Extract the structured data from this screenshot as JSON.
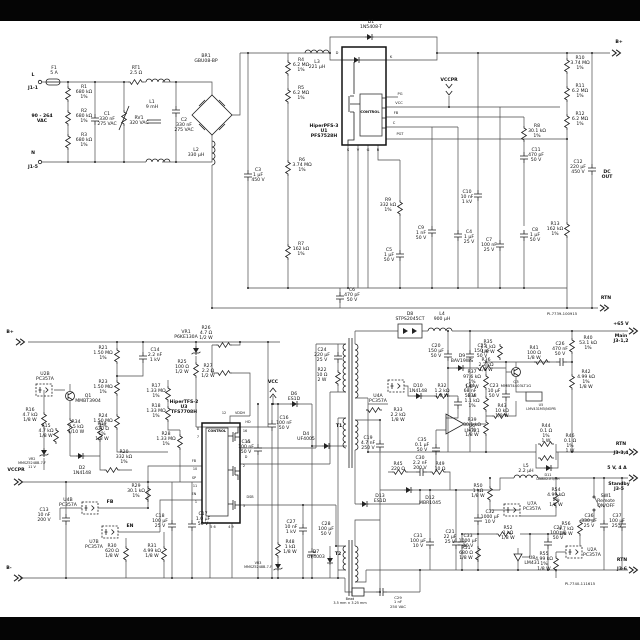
{
  "page": {
    "background": "#ffffff",
    "letterbox_color": "#050505"
  },
  "doc_ids": {
    "top_sheet": "PI-7739-100915",
    "bottom_sheet": "PI-7740-111615"
  },
  "labels": [
    {
      "t": "F1\n5 A",
      "x": 54,
      "y": 66
    },
    {
      "t": "L",
      "x": 33,
      "y": 73,
      "b": 1
    },
    {
      "t": "J1-1",
      "x": 33,
      "y": 86,
      "b": 1
    },
    {
      "t": "90 - 264\nVAC",
      "x": 42,
      "y": 114,
      "b": 1
    },
    {
      "t": "N",
      "x": 33,
      "y": 151,
      "b": 1
    },
    {
      "t": "J1-5",
      "x": 33,
      "y": 165,
      "b": 1
    },
    {
      "t": "R1\n680 kΩ\n1%",
      "x": 84,
      "y": 85
    },
    {
      "t": "R2\n680 kΩ\n1%",
      "x": 84,
      "y": 109
    },
    {
      "t": "R3\n680 kΩ\n1%",
      "x": 84,
      "y": 133
    },
    {
      "t": "C1\n330 nF\n275 VAC",
      "x": 107,
      "y": 112
    },
    {
      "t": "RV1\n320 VAC",
      "x": 139,
      "y": 116
    },
    {
      "t": "RT1\n2.5 Ω",
      "x": 136,
      "y": 66
    },
    {
      "t": "L1\n9 mH",
      "x": 152,
      "y": 100
    },
    {
      "t": "C2\n330 nF\n275 VAC",
      "x": 184,
      "y": 118
    },
    {
      "t": "BR1\nGBU08-BP",
      "x": 206,
      "y": 54
    },
    {
      "t": "L2\n330 µH",
      "x": 196,
      "y": 148
    },
    {
      "t": "D1\n1N5408-T",
      "x": 371,
      "y": 20
    },
    {
      "t": "L3\n221 µH",
      "x": 317,
      "y": 60
    },
    {
      "t": "HiperPFS-3\nU1\nPFS7528H",
      "x": 324,
      "y": 124,
      "b": 1
    },
    {
      "t": "CONTROL",
      "x": 370,
      "y": 110,
      "s": 3.6,
      "b": 1
    },
    {
      "t": "D",
      "x": 337,
      "y": 51,
      "s": 3.6
    },
    {
      "t": "K",
      "x": 391,
      "y": 55,
      "s": 3.6
    },
    {
      "t": "PG",
      "x": 400,
      "y": 92,
      "s": 3.6
    },
    {
      "t": "VCC",
      "x": 399,
      "y": 101,
      "s": 3.6
    },
    {
      "t": "FB",
      "x": 396,
      "y": 111,
      "s": 3.6
    },
    {
      "t": "C",
      "x": 394,
      "y": 121,
      "s": 3.6
    },
    {
      "t": "PGT",
      "x": 400,
      "y": 132,
      "s": 3.6
    },
    {
      "t": "S",
      "x": 348,
      "y": 148,
      "s": 3.6
    },
    {
      "t": "V",
      "x": 358,
      "y": 148,
      "s": 3.6
    },
    {
      "t": "G",
      "x": 368,
      "y": 148,
      "s": 3.6
    },
    {
      "t": "R",
      "x": 378,
      "y": 148,
      "s": 3.6
    },
    {
      "t": "VCCPR",
      "x": 449,
      "y": 78,
      "b": 1
    },
    {
      "t": "R4\n6.2 MΩ\n1%",
      "x": 301,
      "y": 58
    },
    {
      "t": "R5\n6.2 MΩ\n1%",
      "x": 301,
      "y": 86
    },
    {
      "t": "R6\n3.74 MΩ\n1%",
      "x": 302,
      "y": 158
    },
    {
      "t": "C3\n1 µF\n450 V",
      "x": 258,
      "y": 168
    },
    {
      "t": "R7\n162 kΩ\n1%",
      "x": 301,
      "y": 242
    },
    {
      "t": "R9\n332 kΩ\n1%",
      "x": 388,
      "y": 198
    },
    {
      "t": "C5\n1 µF\n50 V",
      "x": 389,
      "y": 248
    },
    {
      "t": "C6\n470 pF\n50 V",
      "x": 352,
      "y": 288
    },
    {
      "t": "C9\n1 nF\n50 V",
      "x": 421,
      "y": 226
    },
    {
      "t": "C4\n1 µF\n25 V",
      "x": 469,
      "y": 230
    },
    {
      "t": "C10\n10 nF\n1 kV",
      "x": 467,
      "y": 190
    },
    {
      "t": "C7\n100 nF\n25 V",
      "x": 489,
      "y": 238
    },
    {
      "t": "R8\n30.1 kΩ\n1%",
      "x": 537,
      "y": 124
    },
    {
      "t": "C11\n470 pF\n50 V",
      "x": 536,
      "y": 148
    },
    {
      "t": "C8\n1 µF\n50 V",
      "x": 535,
      "y": 228
    },
    {
      "t": "R13\n162 kΩ\n1%",
      "x": 555,
      "y": 222
    },
    {
      "t": "C12\n220 µF\n450 V",
      "x": 578,
      "y": 160
    },
    {
      "t": "DC\nOUT",
      "x": 607,
      "y": 170,
      "b": 1
    },
    {
      "t": "R10\n3.74 MΩ\n1%",
      "x": 580,
      "y": 56
    },
    {
      "t": "R11\n6.2 MΩ\n1%",
      "x": 580,
      "y": 84
    },
    {
      "t": "R12\n6.2 MΩ\n1%",
      "x": 580,
      "y": 112
    },
    {
      "t": "B+",
      "x": 619,
      "y": 40,
      "b": 1
    },
    {
      "t": "RTN",
      "x": 606,
      "y": 296,
      "b": 1
    },
    {
      "t": "PI-7739-100915",
      "x": 562,
      "y": 312,
      "s": 3.8
    },
    {
      "t": "B+",
      "x": 10,
      "y": 330,
      "b": 1
    },
    {
      "t": "R21\n1.50 MΩ\n1%",
      "x": 103,
      "y": 346
    },
    {
      "t": "R23\n1.50 MΩ\n1%",
      "x": 103,
      "y": 380
    },
    {
      "t": "R24\n1.50 MΩ\n1%",
      "x": 103,
      "y": 414
    },
    {
      "t": "C14\n2.2 nF\n1 kV",
      "x": 155,
      "y": 348
    },
    {
      "t": "VR1\nP6KE130A",
      "x": 186,
      "y": 330
    },
    {
      "t": "R25\n100 Ω\n1/2 W",
      "x": 182,
      "y": 360
    },
    {
      "t": "R26\n4.7 Ω\n1/2 W",
      "x": 206,
      "y": 326
    },
    {
      "t": "R27\n2.2 Ω\n1/2 W",
      "x": 208,
      "y": 364
    },
    {
      "t": "R17\n1.33 MΩ\n1%",
      "x": 156,
      "y": 384
    },
    {
      "t": "R18\n1.33 MΩ\n1%",
      "x": 156,
      "y": 404
    },
    {
      "t": "R28\n1.33 MΩ\n1%",
      "x": 166,
      "y": 432
    },
    {
      "t": "U2B\nPC357A",
      "x": 45,
      "y": 372
    },
    {
      "t": "R16\n4.7 kΩ\n1/8 W",
      "x": 30,
      "y": 408
    },
    {
      "t": "Q1\nMMBT3904",
      "x": 88,
      "y": 394
    },
    {
      "t": "R15\n4.7 kΩ\n1/8 W",
      "x": 46,
      "y": 424
    },
    {
      "t": "VR2\nMMSZ5248B-7-F\n11 V",
      "x": 32,
      "y": 458,
      "s": 3.4
    },
    {
      "t": "R34\n7.5 kΩ\n1/10 W",
      "x": 76,
      "y": 420
    },
    {
      "t": "R19\n620 Ω\n1%\n1/8 W",
      "x": 102,
      "y": 422
    },
    {
      "t": "R20\n332 kΩ\n1%",
      "x": 124,
      "y": 450
    },
    {
      "t": "D2\n1N4148",
      "x": 82,
      "y": 466
    },
    {
      "t": "HiperTFS-2\nU3\nTFS7708H",
      "x": 184,
      "y": 400,
      "b": 1
    },
    {
      "t": "CONTROL",
      "x": 217,
      "y": 430,
      "s": 3.4,
      "b": 1
    },
    {
      "t": "VDDH",
      "x": 240,
      "y": 412,
      "s": 3.4
    },
    {
      "t": "12",
      "x": 224,
      "y": 412,
      "s": 3.4
    },
    {
      "t": "HD",
      "x": 248,
      "y": 421,
      "s": 3.4
    },
    {
      "t": "16",
      "x": 245,
      "y": 430,
      "s": 3.4
    },
    {
      "t": "HS",
      "x": 248,
      "y": 441,
      "s": 3.4
    },
    {
      "t": "D",
      "x": 246,
      "y": 456,
      "s": 3.4
    },
    {
      "t": "2",
      "x": 244,
      "y": 465,
      "s": 3.4
    },
    {
      "t": "DSB",
      "x": 250,
      "y": 496,
      "s": 3.4
    },
    {
      "t": "3",
      "x": 244,
      "y": 505,
      "s": 3.4
    },
    {
      "t": "8",
      "x": 198,
      "y": 428,
      "s": 3.4
    },
    {
      "t": "7",
      "x": 198,
      "y": 436,
      "s": 3.4
    },
    {
      "t": "FB",
      "x": 194,
      "y": 460,
      "s": 3.4
    },
    {
      "t": "10",
      "x": 195,
      "y": 468,
      "s": 3.4
    },
    {
      "t": "SP",
      "x": 194,
      "y": 477,
      "s": 3.4
    },
    {
      "t": "11",
      "x": 195,
      "y": 485,
      "s": 3.4
    },
    {
      "t": "EN",
      "x": 194,
      "y": 493,
      "s": 3.4
    },
    {
      "t": "1",
      "x": 196,
      "y": 501,
      "s": 3.4
    },
    {
      "t": "5 6",
      "x": 213,
      "y": 526,
      "s": 3.4
    },
    {
      "t": "4 9",
      "x": 231,
      "y": 526,
      "s": 3.4
    },
    {
      "t": "VCC",
      "x": 273,
      "y": 380,
      "b": 1
    },
    {
      "t": "D6\nES1D",
      "x": 294,
      "y": 392
    },
    {
      "t": "C16\n100 nF\n50 V",
      "x": 284,
      "y": 416
    },
    {
      "t": "C15\n100 nF\n50 V",
      "x": 246,
      "y": 440
    },
    {
      "t": "C27\n10 nF\n1 kV",
      "x": 291,
      "y": 520
    },
    {
      "t": "C17\n1.0 µF\n50 V",
      "x": 203,
      "y": 512
    },
    {
      "t": "C18\n100 µF\n25 V",
      "x": 160,
      "y": 514
    },
    {
      "t": "R29\n30.1 kΩ\n1%",
      "x": 136,
      "y": 484
    },
    {
      "t": "R48\n1 kΩ\n1/8 W",
      "x": 290,
      "y": 540
    },
    {
      "t": "VR3\nMMSZ5248B-7-F",
      "x": 258,
      "y": 562,
      "s": 3.4
    },
    {
      "t": "C28\n100 µF\n50 V",
      "x": 326,
      "y": 522
    },
    {
      "t": "C13\n10 nF\n200 V",
      "x": 44,
      "y": 508
    },
    {
      "t": "U4B\nPC357A",
      "x": 68,
      "y": 498
    },
    {
      "t": "FB",
      "x": 110,
      "y": 500,
      "b": 1
    },
    {
      "t": "U7B\nPC357A",
      "x": 94,
      "y": 540
    },
    {
      "t": "EN",
      "x": 130,
      "y": 524,
      "b": 1
    },
    {
      "t": "R30\n620 Ω\n1/8 W",
      "x": 112,
      "y": 544
    },
    {
      "t": "R31\n4.99 kΩ\n1/8 W",
      "x": 152,
      "y": 544
    },
    {
      "t": "VCCPR",
      "x": 16,
      "y": 468,
      "b": 1
    },
    {
      "t": "B-",
      "x": 9,
      "y": 566,
      "b": 1
    },
    {
      "t": "T1",
      "x": 339,
      "y": 424,
      "b": 1
    },
    {
      "t": "D4\nUF4005",
      "x": 306,
      "y": 432
    },
    {
      "t": "C19\n4.7 nF\n250 V",
      "x": 368,
      "y": 436
    },
    {
      "t": "C24\n220 µF\n25 V",
      "x": 322,
      "y": 348
    },
    {
      "t": "R22\n10 Ω\n2 W",
      "x": 322,
      "y": 368
    },
    {
      "t": "D8\nSTPS2045CT",
      "x": 410,
      "y": 312
    },
    {
      "t": "L4\n900 µH",
      "x": 442,
      "y": 312
    },
    {
      "t": "C20\n150 µF\n50 V",
      "x": 436,
      "y": 344
    },
    {
      "t": "C25\n150 µF\n50 V",
      "x": 482,
      "y": 344
    },
    {
      "t": "D9\nBAV19WS",
      "x": 462,
      "y": 354
    },
    {
      "t": "R36\n2.2 kΩ\n1/8 W",
      "x": 486,
      "y": 358
    },
    {
      "t": "U4A\nPC357A",
      "x": 378,
      "y": 394
    },
    {
      "t": "D10\n1N4148",
      "x": 418,
      "y": 384
    },
    {
      "t": "R32\n1.2 kΩ\n1/8 W",
      "x": 442,
      "y": 384
    },
    {
      "t": "C34\n68 nF\n50 V",
      "x": 470,
      "y": 384
    },
    {
      "t": "R33\n2.2 kΩ\n1/8 W",
      "x": 398,
      "y": 408
    },
    {
      "t": "U6\nLM321",
      "x": 472,
      "y": 424
    },
    {
      "t": "C35\n0.1 µF\n50 V",
      "x": 422,
      "y": 438
    },
    {
      "t": "R45\n220 Ω",
      "x": 398,
      "y": 462
    },
    {
      "t": "C30\n2.2 nF\n200 V",
      "x": 420,
      "y": 456
    },
    {
      "t": "R49\n10 Ω",
      "x": 440,
      "y": 462
    },
    {
      "t": "D12\nMBR1045",
      "x": 430,
      "y": 496
    },
    {
      "t": "D13\nES1D",
      "x": 380,
      "y": 494
    },
    {
      "t": "C31\n100 µF\n10 V",
      "x": 418,
      "y": 534
    },
    {
      "t": "C33\n1000 µF\n10 V",
      "x": 468,
      "y": 534
    },
    {
      "t": "C32\n1000 µF\n10 V",
      "x": 490,
      "y": 510
    },
    {
      "t": "T2",
      "x": 338,
      "y": 552,
      "b": 1
    },
    {
      "t": "D7\nUF4003",
      "x": 316,
      "y": 550
    },
    {
      "t": "Bead\n3.5 mm × 3.25 mm",
      "x": 350,
      "y": 598,
      "s": 3.4
    },
    {
      "t": "C29\n1 nF\n250 VAC",
      "x": 398,
      "y": 596,
      "s": 3.8
    },
    {
      "t": "+65 V",
      "x": 621,
      "y": 322,
      "b": 1
    },
    {
      "t": "Main\nJ3-1,2",
      "x": 621,
      "y": 334,
      "b": 1
    },
    {
      "t": "R40\n53.1 kΩ\n1%",
      "x": 588,
      "y": 336
    },
    {
      "t": "R41\n100 Ω\n1/8 W",
      "x": 534,
      "y": 346
    },
    {
      "t": "C26\n470 nF\n50 V",
      "x": 560,
      "y": 342
    },
    {
      "t": "Q3\nMMBT4403LT1G",
      "x": 516,
      "y": 380,
      "s": 3.8
    },
    {
      "t": "R35\n1.1 kΩ\n1/8 W",
      "x": 488,
      "y": 340
    },
    {
      "t": "R37\n97.6 kΩ\n1%\n1/8 W",
      "x": 472,
      "y": 370
    },
    {
      "t": "C23\n10 µF\n50 V",
      "x": 494,
      "y": 384
    },
    {
      "t": "U5\nLMV431M5/NOPB",
      "x": 541,
      "y": 404,
      "s": 3.4
    },
    {
      "t": "R42\n4.99 kΩ\n1%\n1/8 W",
      "x": 586,
      "y": 370
    },
    {
      "t": "R38\n1.1 kΩ\n1%",
      "x": 472,
      "y": 394
    },
    {
      "t": "R43\n10 kΩ\n1/8 W",
      "x": 502,
      "y": 404
    },
    {
      "t": "R39\n30.1 kΩ\n1%\n1/8 W",
      "x": 472,
      "y": 418
    },
    {
      "t": "R44\n0.1 Ω\n1%\n1 W",
      "x": 546,
      "y": 424
    },
    {
      "t": "R46\n0.1 Ω\n1%\n1 W",
      "x": 570,
      "y": 434
    },
    {
      "t": "D11\nDNB02-E3/5H",
      "x": 548,
      "y": 474,
      "s": 3.4
    },
    {
      "t": "RTN",
      "x": 621,
      "y": 442,
      "b": 1
    },
    {
      "t": "J3-3,4",
      "x": 621,
      "y": 451,
      "b": 1
    },
    {
      "t": "5 V, 4 A",
      "x": 617,
      "y": 466,
      "b": 1
    },
    {
      "t": "Standby\nJ3-5",
      "x": 619,
      "y": 482,
      "b": 1
    },
    {
      "t": "L5\n2.2 µH",
      "x": 526,
      "y": 464
    },
    {
      "t": "SW1\nRemote\nON/OFF",
      "x": 606,
      "y": 494
    },
    {
      "t": "R56\n4.7 kΩ\n1/8 W",
      "x": 566,
      "y": 522
    },
    {
      "t": "C36\n330 µF\n25 V",
      "x": 589,
      "y": 514
    },
    {
      "t": "C37\n100 µF\n25 V",
      "x": 617,
      "y": 514
    },
    {
      "t": "U2A\nPC357A",
      "x": 592,
      "y": 548
    },
    {
      "t": "R55\n4.99 kΩ\n1%\n1/8 W",
      "x": 544,
      "y": 552
    },
    {
      "t": "U8\nLM431",
      "x": 532,
      "y": 556
    },
    {
      "t": "U7A\nPC357A",
      "x": 532,
      "y": 502
    },
    {
      "t": "R54\n4.99 kΩ\n1%\n1/8 W",
      "x": 556,
      "y": 488
    },
    {
      "t": "R50\n1 kΩ\n1/8 W",
      "x": 478,
      "y": 484
    },
    {
      "t": "R52\n1 kΩ\n1/8 W",
      "x": 508,
      "y": 526
    },
    {
      "t": "C22\n100 nF\n50 V",
      "x": 558,
      "y": 526
    },
    {
      "t": "C21\n22 µF\n25 V",
      "x": 450,
      "y": 530
    },
    {
      "t": "R51\n680 Ω\n1/8 W",
      "x": 466,
      "y": 546
    },
    {
      "t": "RTN",
      "x": 622,
      "y": 558,
      "b": 1
    },
    {
      "t": "J3-6",
      "x": 622,
      "y": 567,
      "b": 1
    },
    {
      "t": "PI-7740-111615",
      "x": 580,
      "y": 582,
      "s": 3.8
    }
  ]
}
